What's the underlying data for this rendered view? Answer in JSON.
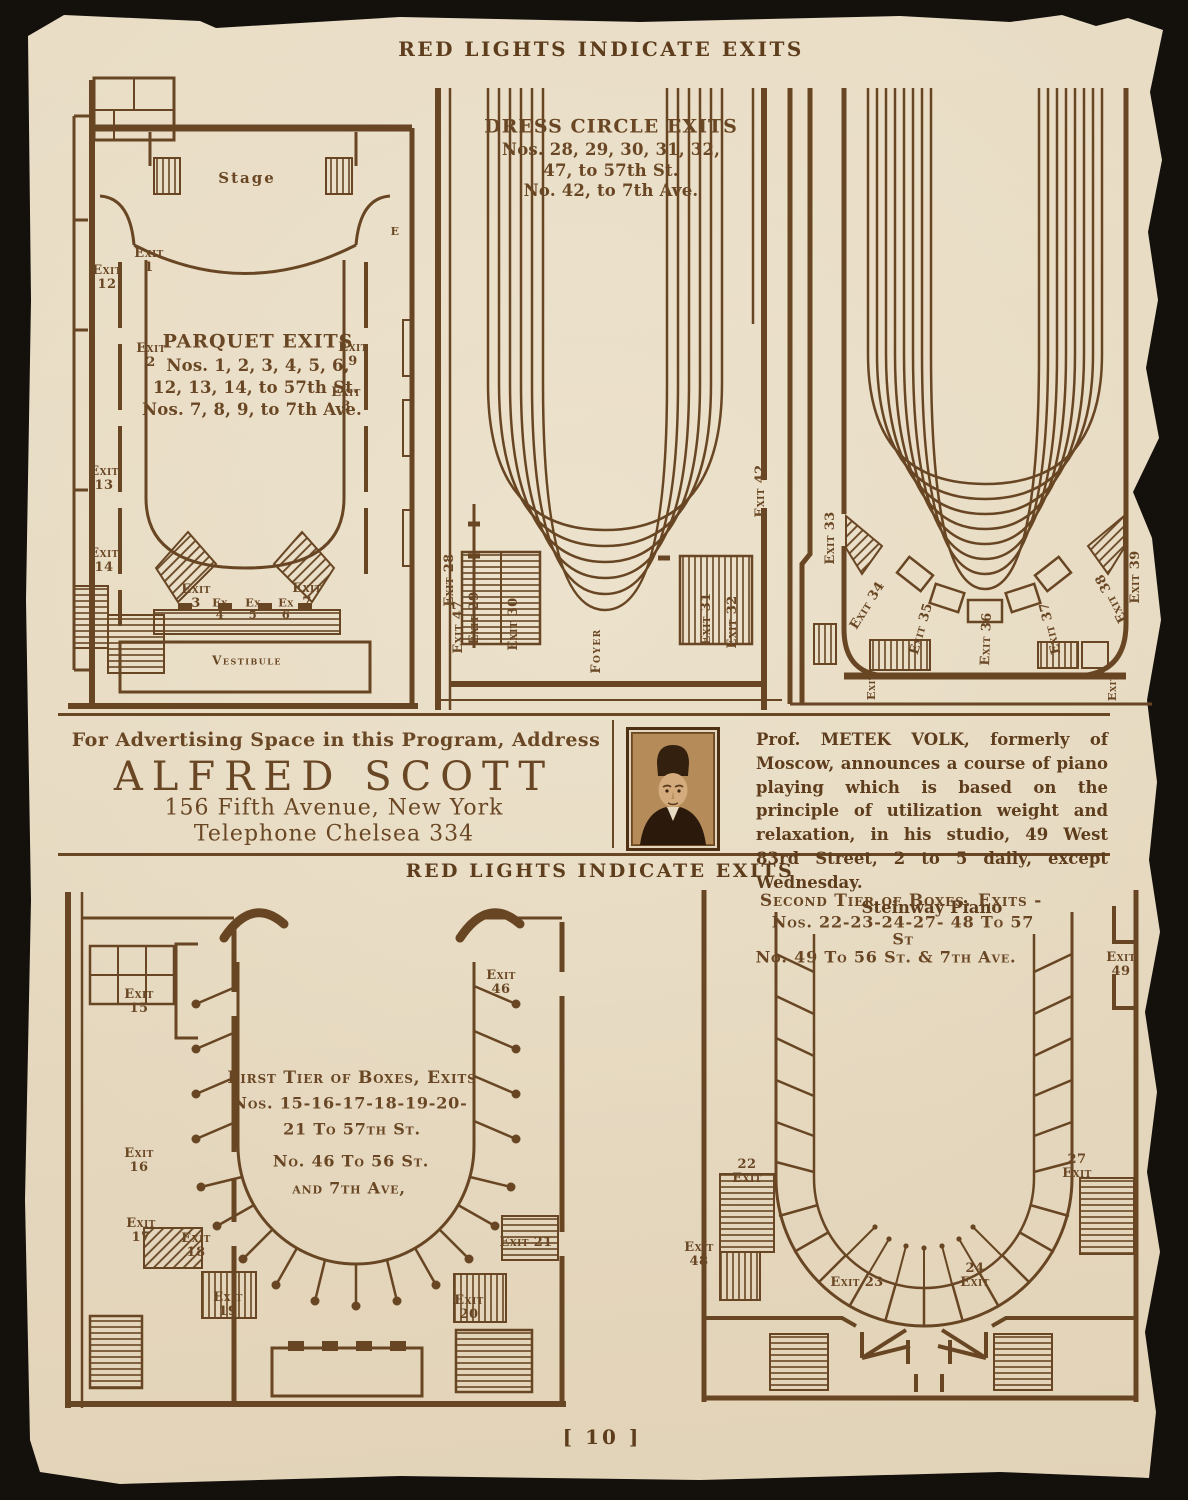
{
  "page": {
    "heading_top": "RED LIGHTS INDICATE EXITS",
    "heading_middle": "RED LIGHTS INDICATE EXITS",
    "page_number": "[ 10 ]"
  },
  "plans": {
    "parquet": {
      "stage": "Stage",
      "title": "PARQUET EXITS",
      "l1": "Nos. 1, 2, 3, 4, 5, 6,",
      "l2": "12, 13, 14, to 57th St.",
      "l3": "Nos. 7, 8, 9, to 7th Ave.",
      "vestibule": "Vestibule",
      "exits": {
        "e1": "Exit\n1",
        "e2": "Exit\n2",
        "e3": "Exit\n3",
        "e4": "Ex\n4",
        "e5": "Ex\n5",
        "e6": "Ex\n6",
        "e7": "Exit\n7",
        "e8": "Exit\n8",
        "e9": "Exit\n9",
        "e12": "Exit\n12",
        "e13": "Exit\n13",
        "e14": "Exit\n14",
        "eE": "E"
      }
    },
    "dress_circle": {
      "title": "DRESS CIRCLE EXITS",
      "l1": "Nos. 28, 29, 30, 31, 32,",
      "l2": "47, to 57th St.",
      "l3": "No. 42, to 7th Ave.",
      "foyer": "Foyer",
      "exits": {
        "e28": "Exit 28",
        "e29": "Exit 29",
        "e30": "Exit 30",
        "e31": "Exit 31",
        "e32": "Exit 32",
        "e42": "Exit 42",
        "e47": "Exit 47"
      }
    },
    "balcony": {
      "exits": {
        "e33": "Exit 33",
        "e34": "Exit 34",
        "e35": "Exit 35",
        "e36": "Exit 36",
        "e37": "Exit 37",
        "e38": "Exit 38",
        "e39": "Exit 39",
        "corner_left": "Exit",
        "corner_right": "Exit"
      }
    },
    "first_tier": {
      "t1": "First Tier of Boxes, Exits",
      "t2": "Nos. 15-16-17-18-19-20-",
      "t3": "21 To 57th St.",
      "t4": "No. 46 To 56 St.",
      "t5": "and 7th Ave,",
      "exits": {
        "e15": "Exit\n15",
        "e16": "Exit\n16",
        "e17": "Exit\n17",
        "e18": "Exit\n18",
        "e19": "Exit\n19",
        "e20": "Exit\n20",
        "e21": "Exit 21",
        "e46": "Exit\n46"
      }
    },
    "second_tier": {
      "t1": "Second Tier of Boxes. Exits -",
      "t2": "Nos. 22-23-24-27- 48 To 57 St",
      "t3": "No. 49 To 56 St. & 7th Ave.",
      "exits": {
        "e22": "22\nExit",
        "e23": "Exit 23",
        "e24": "24\nExit",
        "e27": "27\nExit",
        "e48": "Exit\n48",
        "e49": "Exit\n49"
      }
    }
  },
  "ads": {
    "left": {
      "line1": "For Advertising Space in this Program, Address",
      "name": "ALFRED SCOTT",
      "line2": "156 Fifth Avenue, New York",
      "line3": "Telephone Chelsea 334"
    },
    "right": {
      "prefix": "Prof.",
      "name": "METEK VOLK,",
      "body": "formerly of Moscow, announces a course of piano playing which is based on the principle of utilization weight and relaxation, in his studio, 49 West 83rd Street, 2 to 5 daily, except Wednesday.",
      "footer": "Steinway Piano"
    }
  }
}
